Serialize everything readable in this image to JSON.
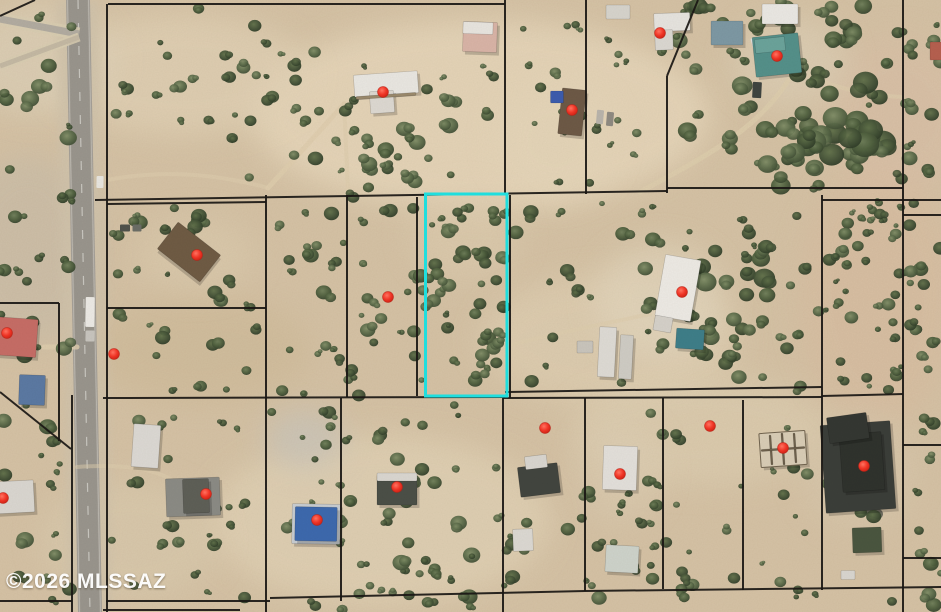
{
  "canvas": {
    "width": 941,
    "height": 612
  },
  "watermark": {
    "text": "©2026 MLSSAZ",
    "color": "#ffffff"
  },
  "map": {
    "type": "satellite-parcel-map",
    "base_color": "#d5c2a5",
    "line_color": "#1a1714",
    "highlight_parcel": {
      "x": 425.5,
      "y": 194,
      "width": 81.5,
      "height": 202,
      "color": "#1fdede",
      "stroke_width": 3
    },
    "markers": {
      "color": "#ef3526",
      "radius": 5.5,
      "points": [
        [
          383,
          92
        ],
        [
          660,
          33
        ],
        [
          777,
          56
        ],
        [
          572,
          110
        ],
        [
          197,
          255
        ],
        [
          114,
          354
        ],
        [
          388,
          297
        ],
        [
          682,
          292
        ],
        [
          7,
          333
        ],
        [
          3,
          498
        ],
        [
          206,
          494
        ],
        [
          317,
          520
        ],
        [
          397,
          487
        ],
        [
          545,
          428
        ],
        [
          620,
          474
        ],
        [
          710,
          426
        ],
        [
          783,
          448
        ],
        [
          864,
          466
        ]
      ]
    },
    "parcel_lines": [
      [
        108,
        4,
        505,
        4
      ],
      [
        107,
        4,
        107,
        612
      ],
      [
        505,
        0,
        505,
        195
      ],
      [
        586,
        0,
        586,
        194
      ],
      [
        698,
        0,
        667,
        76
      ],
      [
        667,
        76,
        667,
        193
      ],
      [
        903,
        0,
        903,
        612
      ],
      [
        95,
        200,
        667,
        191
      ],
      [
        667,
        188,
        903,
        188
      ],
      [
        822,
        200,
        941,
        200
      ],
      [
        107,
        204,
        266,
        202
      ],
      [
        266,
        195,
        266,
        612
      ],
      [
        107,
        308,
        266,
        308
      ],
      [
        347,
        195,
        347,
        397
      ],
      [
        417,
        197,
        417,
        396
      ],
      [
        510,
        195,
        510,
        398
      ],
      [
        822,
        195,
        822,
        590
      ],
      [
        103,
        398,
        505,
        397
      ],
      [
        505,
        392,
        822,
        387
      ],
      [
        503,
        398,
        822,
        397
      ],
      [
        822,
        396,
        903,
        394
      ],
      [
        503,
        398,
        503,
        612
      ],
      [
        585,
        398,
        585,
        591
      ],
      [
        663,
        398,
        663,
        589
      ],
      [
        743,
        400,
        743,
        590
      ],
      [
        341,
        398,
        341,
        601
      ],
      [
        106,
        601,
        270,
        601
      ],
      [
        270,
        598,
        585,
        591
      ],
      [
        585,
        591,
        941,
        587
      ],
      [
        103,
        610,
        240,
        610
      ],
      [
        0,
        303,
        59,
        303
      ],
      [
        59,
        303,
        59,
        441
      ],
      [
        0,
        392,
        71,
        449
      ],
      [
        72,
        395,
        72,
        612
      ],
      [
        0,
        16,
        35,
        0
      ],
      [
        0,
        601,
        72,
        601
      ],
      [
        903,
        215,
        941,
        215
      ],
      [
        903,
        445,
        941,
        445
      ],
      [
        903,
        558,
        941,
        558
      ]
    ],
    "terrain_patches": [
      [
        480,
        115,
        230,
        95,
        "#e7d7bb",
        0.85
      ],
      [
        180,
        75,
        130,
        60,
        "#e3d3b7",
        0.7
      ],
      [
        610,
        340,
        130,
        65,
        "#e2d2b6",
        0.6
      ],
      [
        380,
        520,
        170,
        85,
        "#e4d5b9",
        0.65
      ],
      [
        700,
        430,
        130,
        55,
        "#e0d1b5",
        0.55
      ],
      [
        878,
        295,
        80,
        130,
        "#d9bda1",
        0.6
      ],
      [
        898,
        115,
        75,
        80,
        "#dcc0a8",
        0.5
      ],
      [
        28,
        250,
        75,
        95,
        "#c9bda9",
        0.65
      ],
      [
        40,
        60,
        75,
        55,
        "#ded1b9",
        0.7
      ],
      [
        200,
        350,
        110,
        55,
        "#ccb894",
        0.45
      ],
      [
        465,
        235,
        55,
        45,
        "#e0cfb2",
        0.5
      ],
      [
        305,
        439,
        40,
        30,
        "#cac5b9",
        0.8
      ],
      [
        660,
        300,
        65,
        58,
        "#e4d8c0",
        0.6
      ],
      [
        790,
        62,
        58,
        46,
        "#e0d3bb",
        0.55
      ],
      [
        195,
        255,
        60,
        38,
        "#ddccaf",
        0.55
      ],
      [
        620,
        470,
        42,
        52,
        "#decfb5",
        0.5
      ],
      [
        858,
        470,
        58,
        58,
        "#d9c9af",
        0.5
      ],
      [
        555,
        140,
        60,
        60,
        "#e5d6ba",
        0.6
      ],
      [
        130,
        540,
        90,
        60,
        "#dccdb1",
        0.5
      ]
    ],
    "vegetation_regions": [
      [
        112,
        8,
        210,
        115,
        24,
        2.5,
        7
      ],
      [
        230,
        55,
        270,
        135,
        30,
        2.5,
        8
      ],
      [
        508,
        8,
        78,
        180,
        12,
        2.5,
        6
      ],
      [
        588,
        35,
        75,
        150,
        11,
        2.5,
        6
      ],
      [
        668,
        5,
        235,
        185,
        55,
        3,
        10
      ],
      [
        780,
        50,
        110,
        100,
        14,
        7,
        15
      ],
      [
        905,
        0,
        36,
        200,
        14,
        3,
        8
      ],
      [
        110,
        200,
        156,
        205,
        30,
        2.5,
        8
      ],
      [
        268,
        196,
        158,
        200,
        44,
        2.5,
        8
      ],
      [
        428,
        196,
        78,
        198,
        42,
        2.5,
        8
      ],
      [
        512,
        200,
        310,
        185,
        40,
        2.5,
        8
      ],
      [
        655,
        240,
        125,
        105,
        16,
        5,
        11
      ],
      [
        824,
        200,
        80,
        190,
        40,
        2.5,
        7
      ],
      [
        905,
        200,
        36,
        412,
        26,
        3,
        8
      ],
      [
        100,
        400,
        375,
        210,
        52,
        2.5,
        8
      ],
      [
        480,
        400,
        420,
        205,
        48,
        2.5,
        8
      ],
      [
        0,
        0,
        78,
        612,
        46,
        3,
        9
      ],
      [
        330,
        478,
        150,
        134,
        24,
        3,
        9
      ],
      [
        336,
        100,
        120,
        90,
        14,
        4,
        9
      ],
      [
        736,
        60,
        120,
        120,
        16,
        6,
        13
      ],
      [
        580,
        480,
        110,
        130,
        16,
        3,
        8
      ],
      [
        690,
        330,
        130,
        65,
        12,
        3.5,
        8
      ]
    ],
    "road": {
      "asphalt": "#a5a098",
      "asphalt_dark": "#96928a",
      "shoulder": "#d0c3ab",
      "asphalt_path": "M66,0 L90,0 L102,612 L78,612 Z",
      "inner_path": "M68.5,0 L87.5,0 L99.5,612 L80.5,612 Z",
      "shoulder_path": "M56,0 L100,0 L112,612 L68,612 Z",
      "centerline": "M78,0 L90,612",
      "edge_left": "M67.5,0 L79.5,612",
      "edge_right": "M88.5,0 L100.5,612",
      "diagonals": [
        {
          "d": "M0,19 L79,34",
          "w": 7,
          "c": "#b2aca1",
          "casing": 13
        },
        {
          "d": "M0,66 L79,37",
          "w": 5,
          "c": "#c4b9a4",
          "casing": 9
        }
      ]
    },
    "trails": [
      {
        "d": "M268,188 L344,104",
        "w": 5,
        "o": 0.8
      },
      {
        "d": "M344,103 L348,190",
        "w": 4,
        "o": 0.7
      },
      {
        "d": "M107,180 C170,168 225,176 268,188",
        "w": 4,
        "o": 0.55
      },
      {
        "d": "M640,192 C690,164 756,134 789,79",
        "w": 5,
        "o": 0.75
      },
      {
        "d": "M903,97 C868,95 838,89 810,76",
        "w": 4,
        "o": 0.6
      },
      {
        "d": "M510,345 C560,332 604,324 650,314",
        "w": 4,
        "o": 0.6
      },
      {
        "d": "M77,347 L44,347",
        "w": 5,
        "o": 0.8
      },
      {
        "d": "M77,467 C120,464 152,468 172,480",
        "w": 4,
        "o": 0.5
      },
      {
        "d": "M833,428 C820,465 826,500 878,514",
        "w": 10,
        "o": 0.75,
        "c": "#4a4d46"
      }
    ],
    "buildings": [
      {
        "x": 386,
        "y": 84,
        "w": 64,
        "h": 22,
        "r": -4,
        "f": "#e9e7e2"
      },
      {
        "x": 382,
        "y": 102,
        "w": 24,
        "h": 22,
        "r": -4,
        "f": "#ddd9d2"
      },
      {
        "x": 386,
        "y": 96,
        "w": 60,
        "h": 3,
        "r": -4,
        "f": "#9b8a6d"
      },
      {
        "x": 672,
        "y": 22,
        "w": 36,
        "h": 18,
        "r": -2,
        "f": "#e6e4e0"
      },
      {
        "x": 664,
        "y": 40,
        "w": 18,
        "h": 20,
        "r": -2,
        "f": "#dbd8d2"
      },
      {
        "x": 618,
        "y": 12,
        "w": 24,
        "h": 14,
        "r": 0,
        "f": "#d7d4cd"
      },
      {
        "x": 780,
        "y": 14,
        "w": 36,
        "h": 20,
        "r": 0,
        "f": "#eae8e4"
      },
      {
        "x": 777,
        "y": 55,
        "w": 46,
        "h": 40,
        "r": -6,
        "f": "#54908a"
      },
      {
        "x": 770,
        "y": 45,
        "w": 30,
        "h": 14,
        "r": -6,
        "f": "#6ba39b"
      },
      {
        "x": 727,
        "y": 33,
        "w": 32,
        "h": 24,
        "r": 0,
        "f": "#7d98a4"
      },
      {
        "x": 572,
        "y": 112,
        "w": 24,
        "h": 46,
        "r": 6,
        "f": "#6d5946"
      },
      {
        "x": 557,
        "y": 97,
        "w": 13,
        "h": 12,
        "r": 0,
        "f": "#3c5cae"
      },
      {
        "x": 189,
        "y": 252,
        "w": 54,
        "h": 34,
        "r": 38,
        "f": "#6f5b44"
      },
      {
        "x": 14,
        "y": 337,
        "w": 46,
        "h": 38,
        "r": 4,
        "f": "#c66d66"
      },
      {
        "x": 32,
        "y": 390,
        "w": 26,
        "h": 30,
        "r": 2,
        "f": "#5b79a3"
      },
      {
        "x": 678,
        "y": 288,
        "w": 36,
        "h": 62,
        "r": 10,
        "f": "#edeae5"
      },
      {
        "x": 663,
        "y": 324,
        "w": 18,
        "h": 15,
        "r": 10,
        "f": "#d5d1ca"
      },
      {
        "x": 690,
        "y": 339,
        "w": 28,
        "h": 20,
        "r": 4,
        "f": "#3e7e89"
      },
      {
        "x": 607,
        "y": 352,
        "w": 17,
        "h": 50,
        "r": 3,
        "f": "#dedbd5"
      },
      {
        "x": 626,
        "y": 357,
        "w": 13,
        "h": 44,
        "r": 3,
        "f": "#cfccc5"
      },
      {
        "x": 585,
        "y": 347,
        "w": 16,
        "h": 12,
        "r": 0,
        "f": "#c9c5bd"
      },
      {
        "x": 193,
        "y": 497,
        "w": 54,
        "h": 38,
        "r": -2,
        "f": "#8b8b85"
      },
      {
        "x": 196,
        "y": 496,
        "w": 26,
        "h": 34,
        "r": -2,
        "f": "#5e5f57"
      },
      {
        "x": 146,
        "y": 446,
        "w": 27,
        "h": 43,
        "r": 4,
        "f": "#dcd9d4"
      },
      {
        "x": 316,
        "y": 524,
        "w": 48,
        "h": 40,
        "r": 1,
        "f": "#c8cdd2"
      },
      {
        "x": 316,
        "y": 524,
        "w": 42,
        "h": 34,
        "r": 1,
        "f": "#3d69ae"
      },
      {
        "x": 397,
        "y": 490,
        "w": 40,
        "h": 30,
        "r": 0,
        "f": "#4b4f47"
      },
      {
        "x": 397,
        "y": 477,
        "w": 40,
        "h": 8,
        "r": 0,
        "f": "#dad7d1"
      },
      {
        "x": 539,
        "y": 480,
        "w": 40,
        "h": 30,
        "r": -7,
        "f": "#42453f"
      },
      {
        "x": 536,
        "y": 462,
        "w": 22,
        "h": 13,
        "r": -7,
        "f": "#d9d6d0"
      },
      {
        "x": 620,
        "y": 468,
        "w": 34,
        "h": 44,
        "r": 2,
        "f": "#e3e0db"
      },
      {
        "x": 622,
        "y": 559,
        "w": 33,
        "h": 27,
        "r": 3,
        "f": "#ced3cb"
      },
      {
        "x": 523,
        "y": 540,
        "w": 20,
        "h": 22,
        "r": -2,
        "f": "#dcd9d3"
      },
      {
        "x": 783,
        "y": 449,
        "w": 46,
        "h": 34,
        "r": -4,
        "f": "#d9cdb6",
        "s": "#70634e"
      },
      {
        "x": 771,
        "y": 450,
        "w": 2,
        "h": 30,
        "r": -4,
        "f": "#6f624d"
      },
      {
        "x": 783,
        "y": 449,
        "w": 2,
        "h": 32,
        "r": -4,
        "f": "#6f624d"
      },
      {
        "x": 795,
        "y": 448,
        "w": 2,
        "h": 30,
        "r": -4,
        "f": "#6f624d"
      },
      {
        "x": 783,
        "y": 449,
        "w": 44,
        "h": 2,
        "r": -4,
        "f": "#6f624d"
      },
      {
        "x": 858,
        "y": 467,
        "w": 70,
        "h": 88,
        "r": -4,
        "f": "#3b3e39"
      },
      {
        "x": 862,
        "y": 462,
        "w": 42,
        "h": 58,
        "r": -4,
        "f": "#2f322d"
      },
      {
        "x": 848,
        "y": 428,
        "w": 40,
        "h": 26,
        "r": -8,
        "f": "#343732"
      },
      {
        "x": 867,
        "y": 540,
        "w": 29,
        "h": 25,
        "r": -2,
        "f": "#4a563f"
      },
      {
        "x": 848,
        "y": 575,
        "w": 14,
        "h": 9,
        "r": 0,
        "f": "#d9d6d0"
      },
      {
        "x": 13,
        "y": 497,
        "w": 42,
        "h": 32,
        "r": -3,
        "f": "#dad7d1"
      },
      {
        "x": 480,
        "y": 37,
        "w": 34,
        "h": 30,
        "r": 2,
        "f": "#d9b4a7"
      },
      {
        "x": 478,
        "y": 28,
        "w": 30,
        "h": 12,
        "r": 2,
        "f": "#e8e5e0"
      },
      {
        "x": 936,
        "y": 51,
        "w": 12,
        "h": 18,
        "r": 0,
        "f": "#b6604f"
      }
    ],
    "vehicles": [
      {
        "x": 90,
        "y": 312,
        "w": 9,
        "h": 30,
        "r": 1,
        "f": "#eceae6"
      },
      {
        "x": 90,
        "y": 336,
        "w": 9,
        "h": 11,
        "r": 1,
        "f": "#c8c5bf"
      },
      {
        "x": 100,
        "y": 182,
        "w": 7,
        "h": 12,
        "r": 1,
        "f": "#e8e6e1"
      },
      {
        "x": 600,
        "y": 117,
        "w": 7,
        "h": 14,
        "r": 5,
        "f": "#b9b4ac"
      },
      {
        "x": 610,
        "y": 119,
        "w": 7,
        "h": 14,
        "r": 5,
        "f": "#8f8a82"
      },
      {
        "x": 757,
        "y": 90,
        "w": 9,
        "h": 16,
        "r": 3,
        "f": "#3f4440"
      },
      {
        "x": 756,
        "y": 44,
        "w": 8,
        "h": 13,
        "r": -15,
        "f": "#dfe2e2"
      },
      {
        "x": 125,
        "y": 228,
        "w": 10,
        "h": 7,
        "r": 0,
        "f": "#50524c"
      },
      {
        "x": 137,
        "y": 228,
        "w": 9,
        "h": 7,
        "r": 0,
        "f": "#6b6d66"
      }
    ]
  }
}
